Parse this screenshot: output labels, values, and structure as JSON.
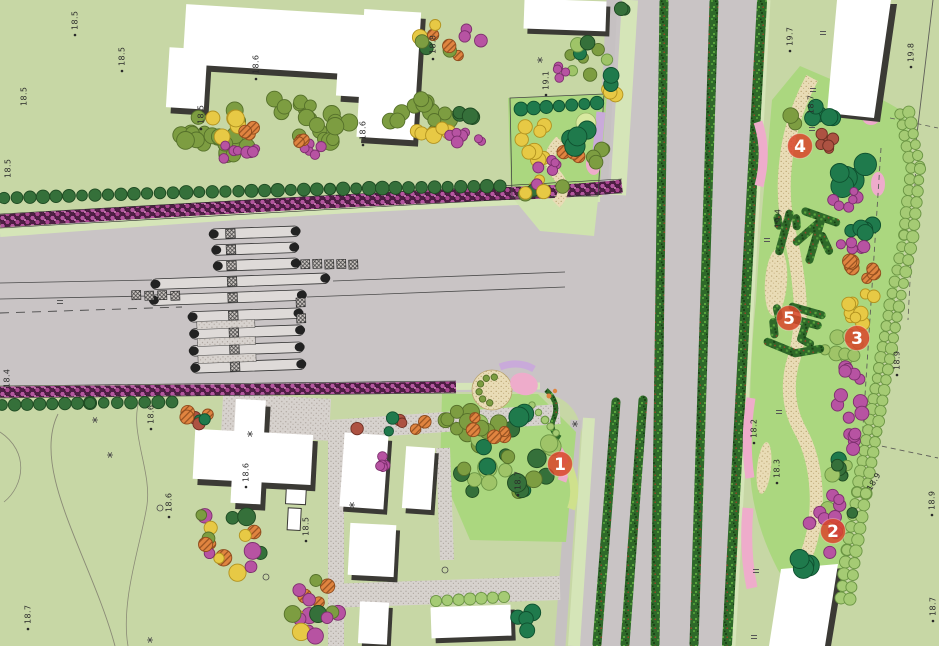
{
  "plan": {
    "type": "landscape-site-plan",
    "markers": [
      {
        "number": "1",
        "x": 560,
        "y": 464
      },
      {
        "number": "2",
        "x": 833,
        "y": 531
      },
      {
        "number": "3",
        "x": 857,
        "y": 338
      },
      {
        "number": "4",
        "x": 800,
        "y": 146
      },
      {
        "number": "5",
        "x": 789,
        "y": 318
      }
    ],
    "hedge_characters": [
      {
        "text": "怀",
        "x": 807,
        "y": 235,
        "rotate": 12,
        "size": 54
      },
      {
        "text": "远",
        "x": 799,
        "y": 332,
        "rotate": 10,
        "size": 54
      }
    ],
    "elevation_labels": [
      {
        "text": "18.5",
        "x": 24,
        "y": 106,
        "rotate": -90,
        "dot": false
      },
      {
        "text": "18.5",
        "x": 75,
        "y": 30,
        "rotate": -90,
        "dot": true
      },
      {
        "text": "18.5",
        "x": 122,
        "y": 66,
        "rotate": -90,
        "dot": true
      },
      {
        "text": "18.5",
        "x": 8,
        "y": 178,
        "rotate": -90,
        "dot": false
      },
      {
        "text": "18.4",
        "x": 7,
        "y": 388,
        "rotate": -90,
        "dot": false
      },
      {
        "text": "18.7",
        "x": 28,
        "y": 624,
        "rotate": -90,
        "dot": true
      },
      {
        "text": "18.6",
        "x": 151,
        "y": 424,
        "rotate": -90,
        "dot": true
      },
      {
        "text": "18.6",
        "x": 169,
        "y": 512,
        "rotate": -90,
        "dot": true
      },
      {
        "text": "18.6",
        "x": 246,
        "y": 482,
        "rotate": -90,
        "dot": true
      },
      {
        "text": "18.5",
        "x": 306,
        "y": 536,
        "rotate": -90,
        "dot": true
      },
      {
        "text": "18.6",
        "x": 256,
        "y": 74,
        "rotate": -90,
        "dot": true
      },
      {
        "text": "18.5",
        "x": 201,
        "y": 124,
        "rotate": -90,
        "dot": true
      },
      {
        "text": "18.6",
        "x": 363,
        "y": 140,
        "rotate": -90,
        "dot": true
      },
      {
        "text": "18.8",
        "x": 433,
        "y": 54,
        "rotate": -90,
        "dot": true
      },
      {
        "text": "18.7",
        "x": 518,
        "y": 490,
        "rotate": -90,
        "dot": true
      },
      {
        "text": "19.1",
        "x": 546,
        "y": 90,
        "rotate": -90,
        "dot": true
      },
      {
        "text": "19.7",
        "x": 790,
        "y": 46,
        "rotate": -90,
        "dot": true
      },
      {
        "text": "19.8",
        "x": 911,
        "y": 62,
        "rotate": -90,
        "dot": true
      },
      {
        "text": "18.7",
        "x": 811,
        "y": 114,
        "rotate": -90,
        "dot": false
      },
      {
        "text": "19.4",
        "x": 778,
        "y": 228,
        "rotate": -90,
        "dot": false
      },
      {
        "text": "18.2",
        "x": 754,
        "y": 438,
        "rotate": -90,
        "dot": true
      },
      {
        "text": "18.3",
        "x": 777,
        "y": 478,
        "rotate": -90,
        "dot": true
      },
      {
        "text": "18.9",
        "x": 897,
        "y": 370,
        "rotate": -90,
        "dot": true
      },
      {
        "text": "18.9",
        "x": 869,
        "y": 490,
        "rotate": -60,
        "dot": false
      },
      {
        "text": "18.9",
        "x": 932,
        "y": 510,
        "rotate": -90,
        "dot": true
      },
      {
        "text": "18.7",
        "x": 933,
        "y": 616,
        "rotate": -90,
        "dot": true
      }
    ],
    "palette": {
      "marker": "#d9472b",
      "lawn": "#c7d7a5",
      "lawn_bright": "#abd77f",
      "road": "#c9c4c5",
      "hedge_purple": "#8e3579",
      "tree_dark": "#35703a",
      "tree_teal": "#1f7a4c",
      "tree_olive": "#7d9d41",
      "tree_light": "#a5cb74",
      "tree_yellow": "#e7c945",
      "tree_orange": "#e08440",
      "tree_magenta": "#b753a2",
      "tree_red": "#ad5242",
      "path_tan": "#e9dcb6",
      "paving_pink": "#eeaccb",
      "paving_lavender": "#c9aada",
      "building": "#ffffff",
      "building_shadow": "#3b3a35",
      "label_color": "#2a2a2a"
    }
  }
}
